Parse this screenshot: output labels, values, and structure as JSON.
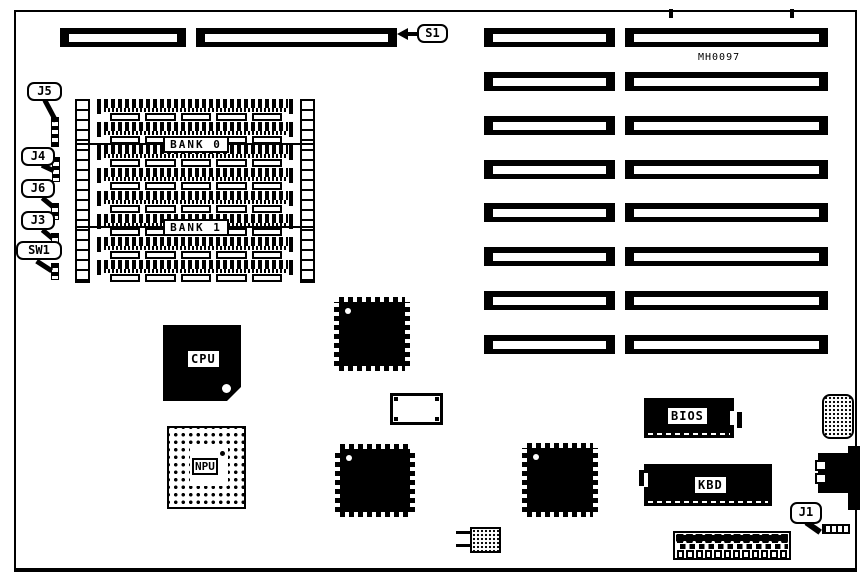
{
  "part_number": "MH0097",
  "callouts": {
    "s1": "S1",
    "j5": "J5",
    "j4": "J4",
    "j6": "J6",
    "j3": "J3",
    "sw1": "SW1",
    "j1": "J1"
  },
  "memory": {
    "bank0_label": "BANK 0",
    "bank1_label": "BANK 1",
    "simm_rows": 8,
    "modules_per_row": 5
  },
  "chips": {
    "cpu_label": "CPU",
    "npu_label": "NPU",
    "bios_label": "BIOS",
    "kbd_label": "KBD"
  },
  "expansion_slots": {
    "rows": 8,
    "columns": 2
  },
  "power_connector": {
    "positions": 12
  },
  "colors": {
    "ink": "#000000",
    "paper": "#ffffff"
  }
}
